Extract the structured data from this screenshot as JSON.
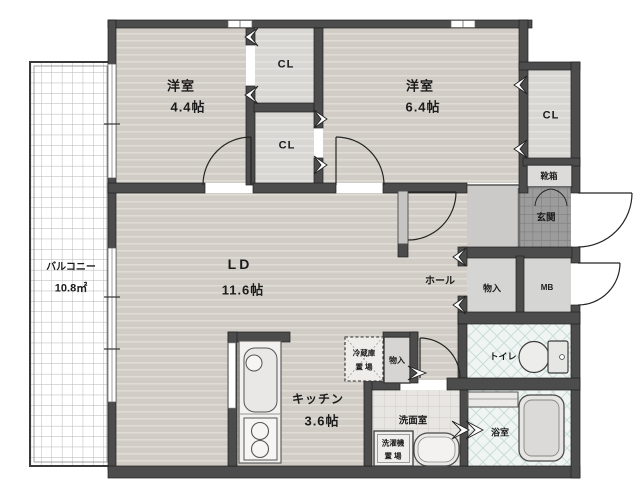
{
  "labels": {
    "bedroom1_name": "洋室",
    "bedroom1_size": "4.4帖",
    "bedroom2_name": "洋室",
    "bedroom2_size": "6.4帖",
    "cl_top": "CL",
    "cl_bottom": "CL",
    "cl_right": "CL",
    "shoebox": "靴箱",
    "entrance": "玄関",
    "balcony_name": "バルコニー",
    "balcony_size": "10.8㎡",
    "living_name": "LD",
    "living_size": "11.6帖",
    "hall": "ホール",
    "storage_hall": "物入",
    "meter_box": "MB",
    "toilet": "トイレ",
    "storage_kitchen": "物入",
    "fridge_line1": "冷蔵庫",
    "fridge_line2": "置 場",
    "kitchen_name": "キッチン",
    "kitchen_size": "3.6帖",
    "washroom": "洗面室",
    "washer_line1": "洗濯機",
    "washer_line2": "置 場",
    "bathroom": "浴室"
  },
  "colors": {
    "wall": "#4c4c4c",
    "wall_outline": "#1f1f1f",
    "wood_floor": "#d1cdc6",
    "wood_stripe": "#dfdbd5",
    "closet_floor": "#d9d7d4",
    "plain_floor": "#cbcac8",
    "genkan_tile": "#9c9c9c",
    "genkan_grout": "#7d7d7d",
    "wet_tile": "#f0f5f3",
    "wet_tile_line": "#c8dbd7",
    "washroom_tile": "#e8e6e2",
    "balcony_grid": "#b3b3b3",
    "fixture_fill": "#ececea"
  }
}
